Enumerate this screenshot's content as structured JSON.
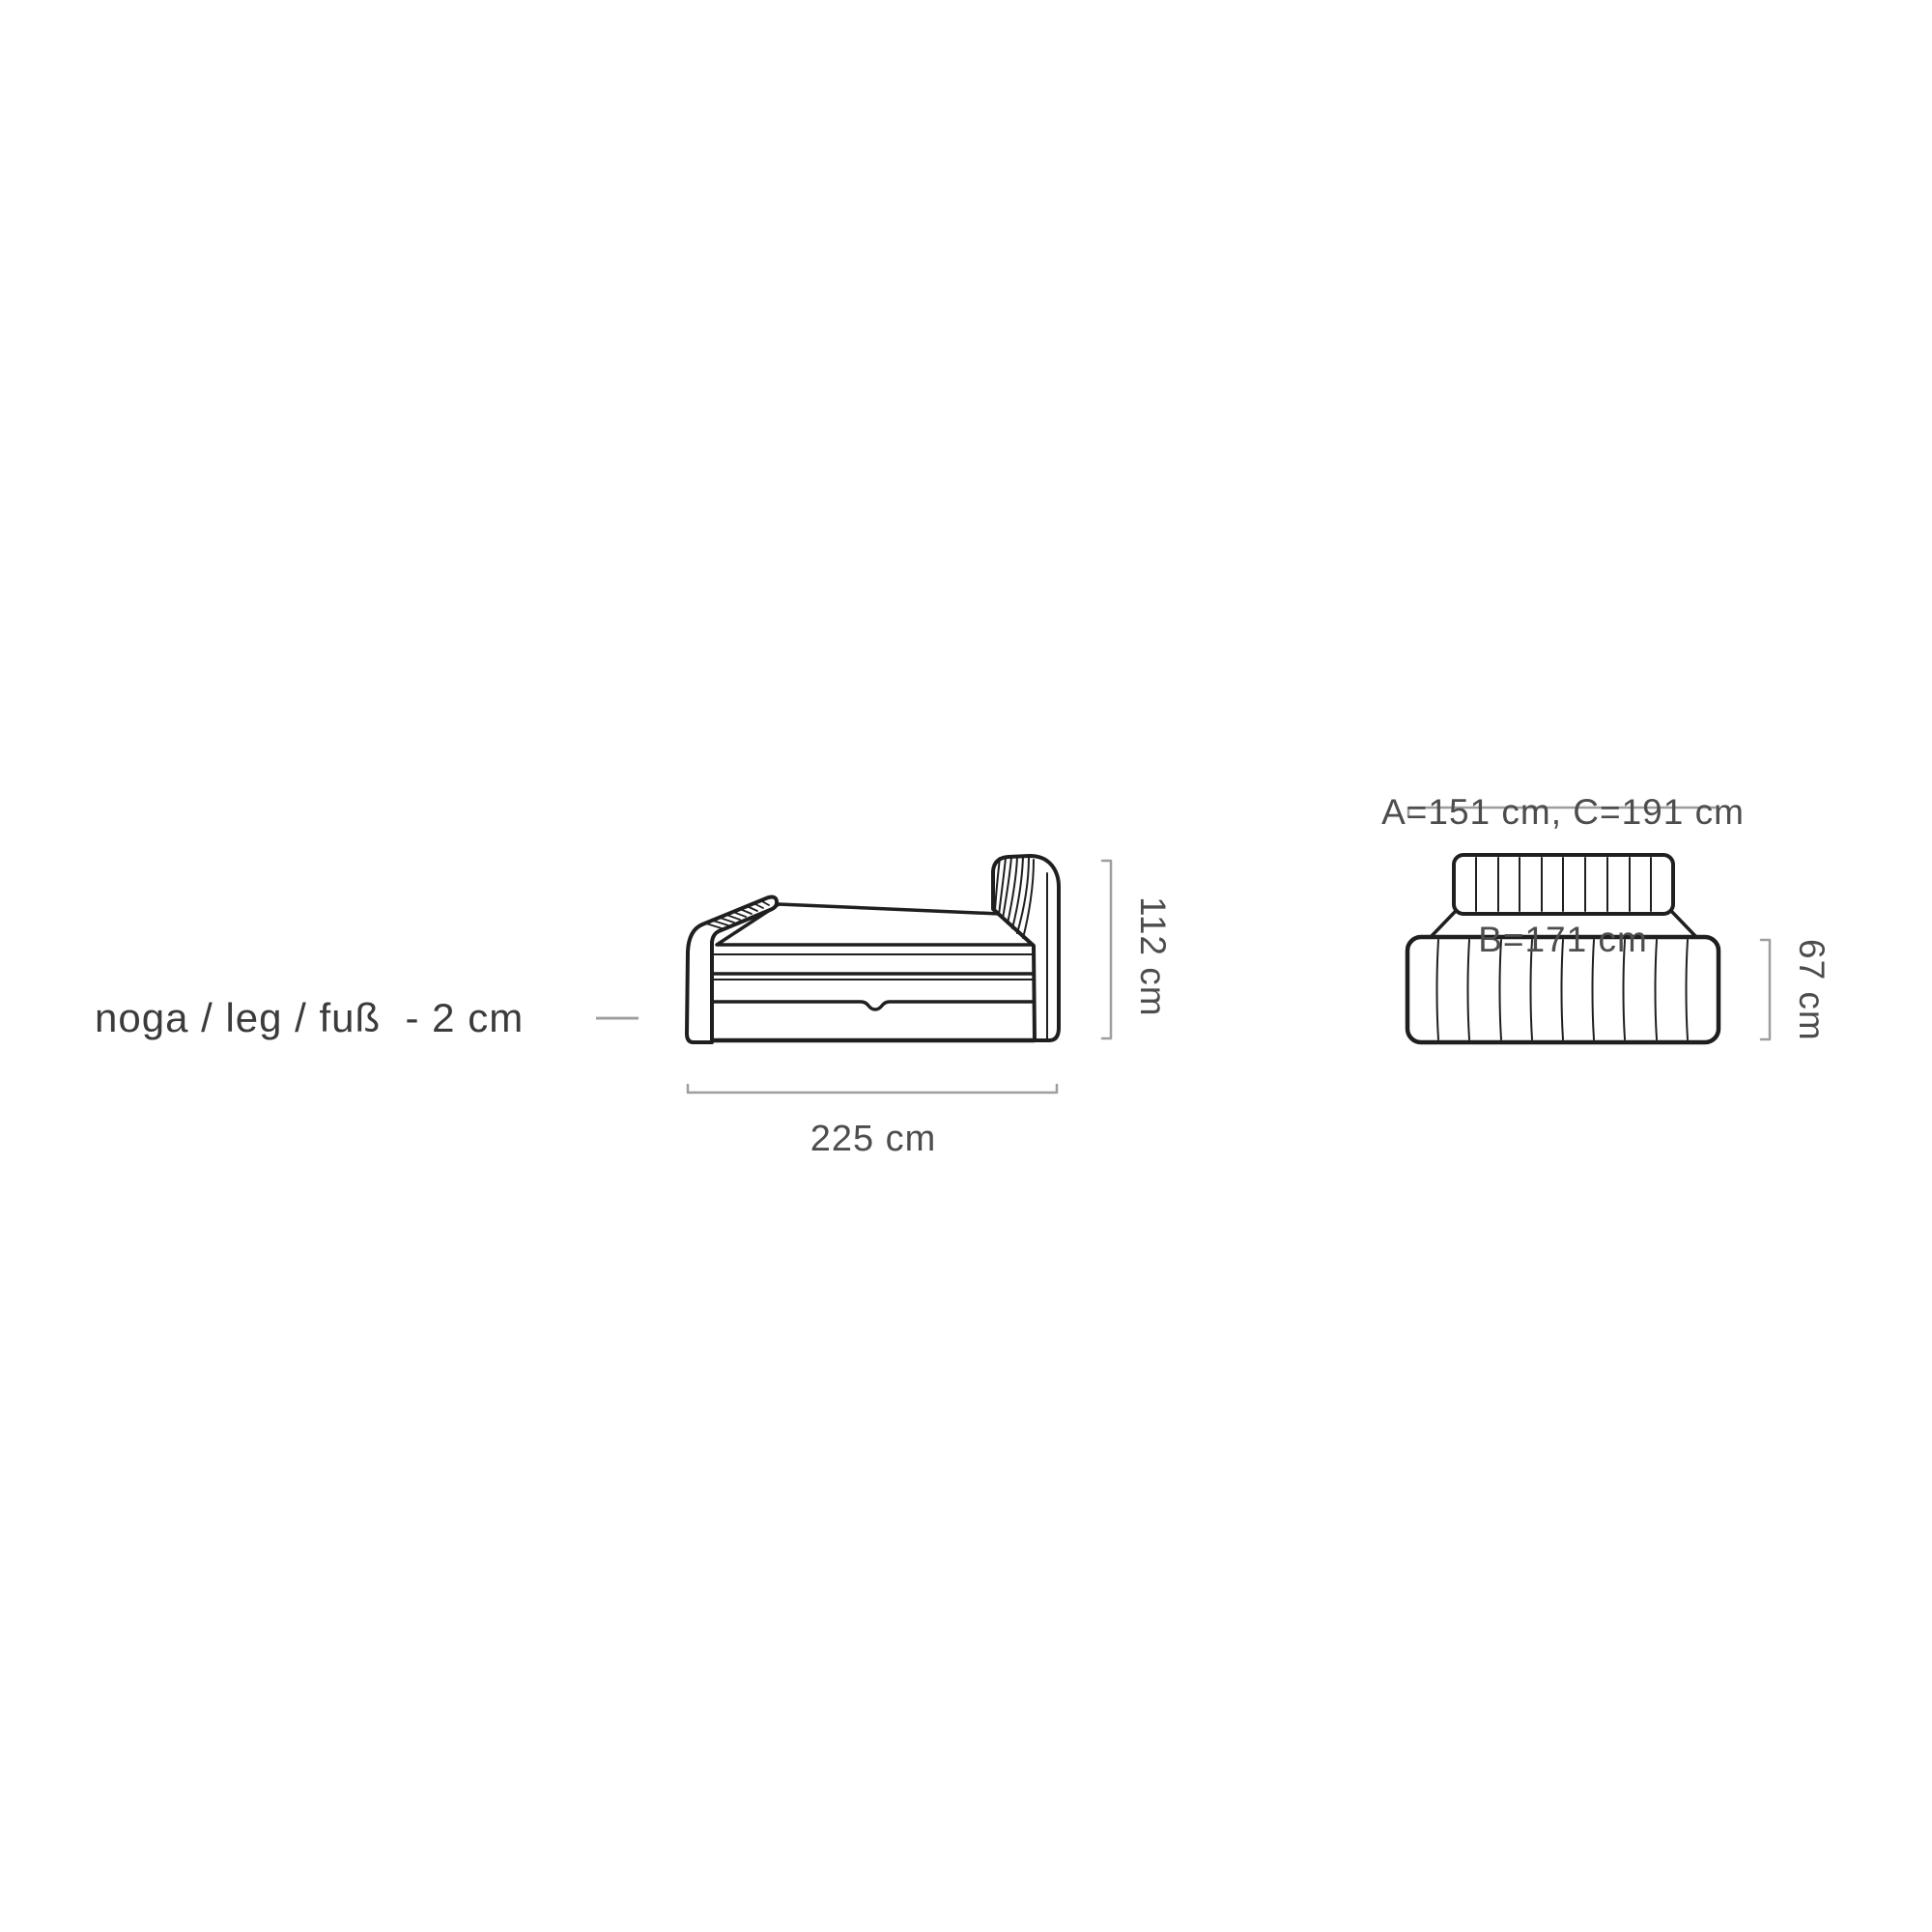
{
  "colors": {
    "outline": "#1f1f1f",
    "dimension_line": "#9e9e9e",
    "label_text": "#3b3b3b",
    "dimension_text": "#4d4d4d",
    "background": "#ffffff"
  },
  "leg_note": {
    "label": "noga / leg / fuß  - 2 cm",
    "dash": "—"
  },
  "side_view": {
    "width_label": "225 cm",
    "height_label": "112 cm"
  },
  "front_view": {
    "size_line_1": "A=151 cm, C=191 cm",
    "size_line_2": "B=171 cm",
    "height_label": "67 cm"
  }
}
